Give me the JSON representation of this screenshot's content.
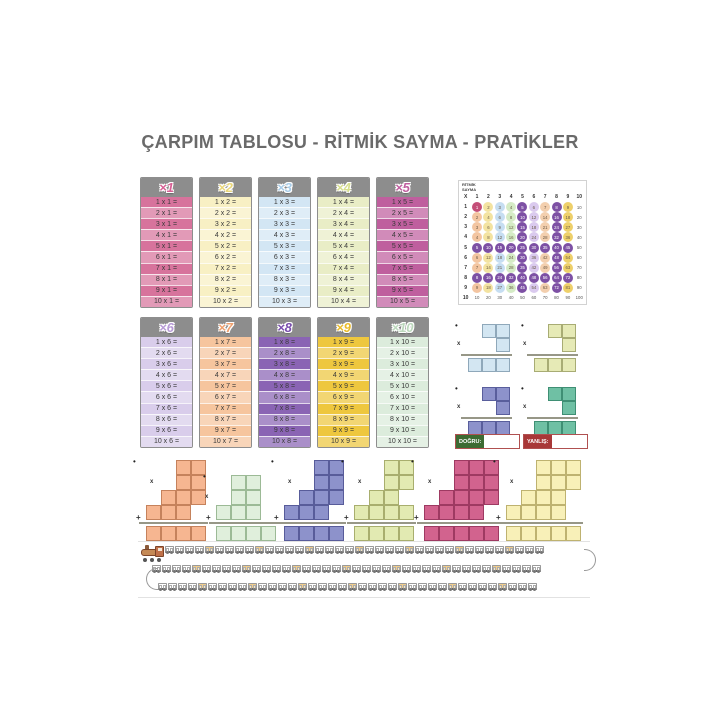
{
  "title": "ÇARPIM TABLOSU - RİTMİK SAYMA - PRATİKLER",
  "markers": {
    "dot": "•",
    "x": "x",
    "plus": "+"
  },
  "cards": [
    {
      "factor": 1,
      "label": "×1",
      "body_bg": "#d7739c",
      "bubble_color": "#d75f94",
      "rows": [
        "1 x 1 =",
        "2 x 1 =",
        "3 x 1 =",
        "4 x 1 =",
        "5 x 1 =",
        "6 x 1 =",
        "7 x 1 =",
        "8 x 1 =",
        "9 x 1 =",
        "10 x 1 ="
      ]
    },
    {
      "factor": 2,
      "label": "×2",
      "body_bg": "#f8f0c4",
      "bubble_color": "#ead77a",
      "rows": [
        "1 x 2 =",
        "2 x 2 =",
        "3 x 2 =",
        "4 x 2 =",
        "5 x 2 =",
        "6 x 2 =",
        "7 x 2 =",
        "8 x 2 =",
        "9 x 2 =",
        "10 x 2 ="
      ]
    },
    {
      "factor": 3,
      "label": "×3",
      "body_bg": "#d3e6f4",
      "bubble_color": "#a8cce8",
      "rows": [
        "1 x 3 =",
        "2 x 3 =",
        "3 x 3 =",
        "4 x 3 =",
        "5 x 3 =",
        "6 x 3 =",
        "7 x 3 =",
        "8 x 3 =",
        "9 x 3 =",
        "10 x 3 ="
      ]
    },
    {
      "factor": 4,
      "label": "×4",
      "body_bg": "#e9edc6",
      "bubble_color": "#d7df8e",
      "rows": [
        "1 x 4 =",
        "2 x 4 =",
        "3 x 4 =",
        "4 x 4 =",
        "5 x 4 =",
        "6 x 4 =",
        "7 x 4 =",
        "8 x 4 =",
        "9 x 4 =",
        "10 x 4 ="
      ]
    },
    {
      "factor": 5,
      "label": "×5",
      "body_bg": "#bf5f9e",
      "bubble_color": "#c05fa0",
      "rows": [
        "1 x 5 =",
        "2 x 5 =",
        "3 x 5 =",
        "4 x 5 =",
        "5 x 5 =",
        "6 x 5 =",
        "7 x 5 =",
        "8 x 5 =",
        "9 x 5 =",
        "10 x 5 ="
      ]
    },
    {
      "factor": 6,
      "label": "×6",
      "body_bg": "#d9cdeb",
      "bubble_color": "#b79ad6",
      "rows": [
        "1 x 6 =",
        "2 x 6 =",
        "3 x 6 =",
        "4 x 6 =",
        "5 x 6 =",
        "6 x 6 =",
        "7 x 6 =",
        "8 x 6 =",
        "9 x 6 =",
        "10 x 6 ="
      ]
    },
    {
      "factor": 7,
      "label": "×7",
      "body_bg": "#f6c59e",
      "bubble_color": "#efa06e",
      "rows": [
        "1 x 7 =",
        "2 x 7 =",
        "3 x 7 =",
        "4 x 7 =",
        "5 x 7 =",
        "6 x 7 =",
        "7 x 7 =",
        "8 x 7 =",
        "9 x 7 =",
        "10 x 7 ="
      ]
    },
    {
      "factor": 8,
      "label": "×8",
      "body_bg": "#8a64b4",
      "bubble_color": "#7a4fae",
      "rows": [
        "1 x 8 =",
        "2 x 8 =",
        "3 x 8 =",
        "4 x 8 =",
        "5 x 8 =",
        "6 x 8 =",
        "7 x 8 =",
        "8 x 8 =",
        "9 x 8 =",
        "10 x 8 ="
      ]
    },
    {
      "factor": 9,
      "label": "×9",
      "body_bg": "#eec73e",
      "bubble_color": "#e9bb2a",
      "rows": [
        "1 x 9 =",
        "2 x 9 =",
        "3 x 9 =",
        "4 x 9 =",
        "5 x 9 =",
        "6 x 9 =",
        "7 x 9 =",
        "8 x 9 =",
        "9 x 9 =",
        "10 x 9 ="
      ]
    },
    {
      "factor": 10,
      "label": "×10",
      "body_bg": "#dcecdc",
      "bubble_color": "#bcd8bc",
      "rows": [
        "1 x 10 =",
        "2 x 10 =",
        "3 x 10 =",
        "4 x 10 =",
        "5 x 10 =",
        "6 x 10 =",
        "7 x 10 =",
        "8 x 10 =",
        "9 x 10 =",
        "10 x 10 ="
      ]
    }
  ],
  "rhythmic_grid": {
    "heading": "RİTMİK\nSAYMA",
    "col_headers": [
      "X",
      "1",
      "2",
      "3",
      "4",
      "5",
      "6",
      "7",
      "8",
      "9",
      "10"
    ],
    "row_headers": [
      "1",
      "2",
      "3",
      "4",
      "5",
      "6",
      "7",
      "8",
      "9",
      "10"
    ],
    "rows": [
      [
        1,
        2,
        3,
        4,
        5,
        6,
        7,
        8,
        9,
        10
      ],
      [
        2,
        4,
        6,
        8,
        10,
        12,
        14,
        16,
        18,
        20
      ],
      [
        3,
        6,
        9,
        12,
        15,
        18,
        21,
        24,
        27,
        30
      ],
      [
        4,
        8,
        12,
        16,
        20,
        24,
        28,
        32,
        36,
        40
      ],
      [
        5,
        10,
        15,
        20,
        25,
        30,
        35,
        40,
        45,
        50
      ],
      [
        6,
        12,
        18,
        24,
        30,
        36,
        42,
        48,
        54,
        60
      ],
      [
        7,
        14,
        21,
        28,
        35,
        42,
        49,
        56,
        63,
        70
      ],
      [
        8,
        16,
        24,
        32,
        40,
        48,
        56,
        64,
        72,
        80
      ],
      [
        9,
        18,
        27,
        36,
        45,
        54,
        63,
        72,
        81,
        90
      ],
      [
        10,
        20,
        30,
        40,
        50,
        60,
        70,
        80,
        90,
        100
      ]
    ],
    "colors": {
      "first": "#c44e78",
      "dark": "#7d50a4",
      "palette": [
        "#f3c5a1",
        "#f3e3a1",
        "#c6def2",
        "#d5ebc6",
        "#7d50a4",
        "#dacaee",
        "#f3cfae",
        "#7d50a4",
        "#eed06a",
        "#ffffff"
      ]
    }
  },
  "small_shapes": [
    {
      "fill": "#d3e6f2",
      "border": "#8fa8ba",
      "cols": 3,
      "rows": [
        [
          1,
          2
        ],
        [
          2,
          1
        ]
      ],
      "bottom": [
        [
          0,
          3
        ]
      ]
    },
    {
      "fill": "#e6eab6",
      "border": "#a8ac74",
      "cols": 3,
      "rows": [
        [
          1,
          2
        ],
        [
          2,
          1
        ]
      ],
      "bottom": [
        [
          0,
          3
        ]
      ]
    },
    {
      "fill": "#8d92cb",
      "border": "#595e9c",
      "cols": 3,
      "rows": [
        [
          1,
          2
        ],
        [
          2,
          1
        ]
      ],
      "bottom": [
        [
          0,
          3
        ]
      ]
    },
    {
      "fill": "#6fc0a4",
      "border": "#3f8f74",
      "cols": 3,
      "rows": [
        [
          1,
          2
        ],
        [
          2,
          1
        ]
      ],
      "bottom": [
        [
          0,
          3
        ]
      ]
    }
  ],
  "answer_bar": {
    "correct_label": "DOĞRU:",
    "wrong_label": "YANLIŞ:"
  },
  "staircase_shapes": [
    {
      "fill": "#f6b691",
      "border": "#c5825c",
      "cols": 4,
      "rows": [
        [
          2,
          2
        ],
        [
          2,
          2
        ],
        [
          1,
          3
        ],
        [
          0,
          3
        ]
      ],
      "bottom": [
        [
          0,
          4
        ]
      ]
    },
    {
      "fill": "#e0efdc",
      "border": "#9cba96",
      "cols": 4,
      "rows": [
        [
          1,
          2
        ],
        [
          1,
          2
        ],
        [
          0,
          3
        ]
      ],
      "bottom": [
        [
          0,
          4
        ]
      ]
    },
    {
      "fill": "#8d92cb",
      "border": "#585c9a",
      "cols": 4,
      "rows": [
        [
          2,
          2
        ],
        [
          2,
          2
        ],
        [
          1,
          3
        ],
        [
          0,
          3
        ]
      ],
      "bottom": [
        [
          0,
          4
        ]
      ]
    },
    {
      "fill": "#e2eab2",
      "border": "#a8ae6e",
      "cols": 4,
      "rows": [
        [
          2,
          2
        ],
        [
          2,
          2
        ],
        [
          1,
          2
        ],
        [
          0,
          4
        ]
      ],
      "bottom": [
        [
          0,
          4
        ]
      ]
    },
    {
      "fill": "#d2638e",
      "border": "#9e3a62",
      "cols": 5,
      "rows": [
        [
          2,
          3
        ],
        [
          2,
          3
        ],
        [
          1,
          4
        ],
        [
          0,
          4
        ]
      ],
      "bottom": [
        [
          0,
          5
        ]
      ]
    },
    {
      "fill": "#f8f0b8",
      "border": "#beb270",
      "cols": 5,
      "rows": [
        [
          2,
          3
        ],
        [
          2,
          3
        ],
        [
          1,
          3
        ],
        [
          0,
          4
        ]
      ],
      "bottom": [
        [
          0,
          5
        ]
      ]
    }
  ],
  "train": {
    "highlight_every": 5,
    "rows": [
      {
        "wagons": 38
      },
      {
        "wagons": 39
      },
      {
        "wagons": 38
      }
    ]
  }
}
